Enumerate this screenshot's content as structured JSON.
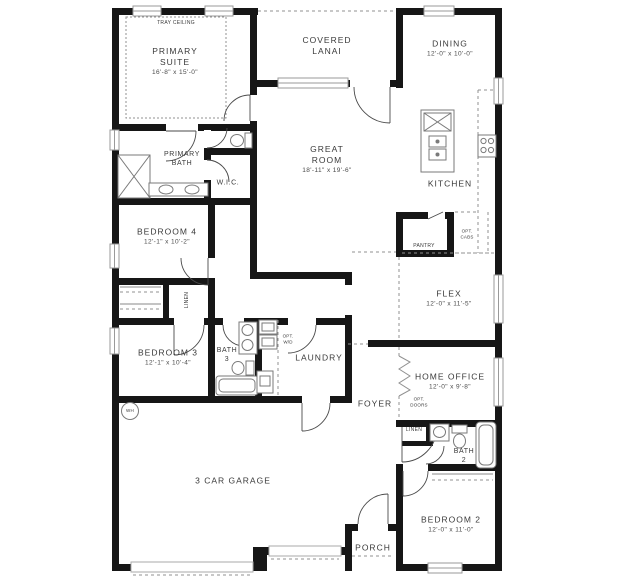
{
  "meta": {
    "kind": "single-story floor plan"
  },
  "colors": {
    "wall": "#161616",
    "fixture": "#7a7a7a",
    "dashed": "#909090",
    "door": "#4a4a4a",
    "text": "#3a3a3a",
    "window_stroke": "#9a9a9a"
  },
  "rooms": {
    "tray_ceiling": {
      "name": "TRAY CEILING"
    },
    "primary_suite": {
      "name": "PRIMARY\nSUITE",
      "dims": "16'-8\" x 15'-0\""
    },
    "covered_lanai": {
      "name": "COVERED\nLANAI"
    },
    "dining": {
      "name": "DINING",
      "dims": "12'-0\" x 10'-0\""
    },
    "great_room": {
      "name": "GREAT\nROOM",
      "dims": "18'-11\" x 19'-6\""
    },
    "kitchen": {
      "name": "KITCHEN"
    },
    "pantry": {
      "name": "PANTRY"
    },
    "opt_cabs": {
      "name": "OPT.\nCABS"
    },
    "primary_bath": {
      "name": "PRIMARY\nBATH"
    },
    "wic": {
      "name": "W.I.C."
    },
    "bedroom4": {
      "name": "BEDROOM 4",
      "dims": "12'-1\" x 10'-2\""
    },
    "linen_hall": {
      "name": "LINEN"
    },
    "bedroom3": {
      "name": "BEDROOM 3",
      "dims": "12'-1\" x 10'-4\""
    },
    "bath3": {
      "name": "BATH\n3"
    },
    "laundry": {
      "name": "LAUNDRY"
    },
    "opt_wd": {
      "name": "OPT.\nW/D"
    },
    "flex": {
      "name": "FLEX",
      "dims": "12'-0\" x 11'-5\""
    },
    "home_office": {
      "name": "HOME OFFICE",
      "dims": "12'-0\" x 9'-8\""
    },
    "opt_doors": {
      "name": "OPT.\nDOORS"
    },
    "foyer": {
      "name": "FOYER"
    },
    "linen_bath2": {
      "name": "LINEN"
    },
    "bath2": {
      "name": "BATH\n2"
    },
    "bedroom2": {
      "name": "BEDROOM 2",
      "dims": "12'-0\" x 11'-0\""
    },
    "porch": {
      "name": "PORCH"
    },
    "garage": {
      "name": "3 CAR GARAGE"
    },
    "water_heater": {
      "name": "WH"
    }
  }
}
